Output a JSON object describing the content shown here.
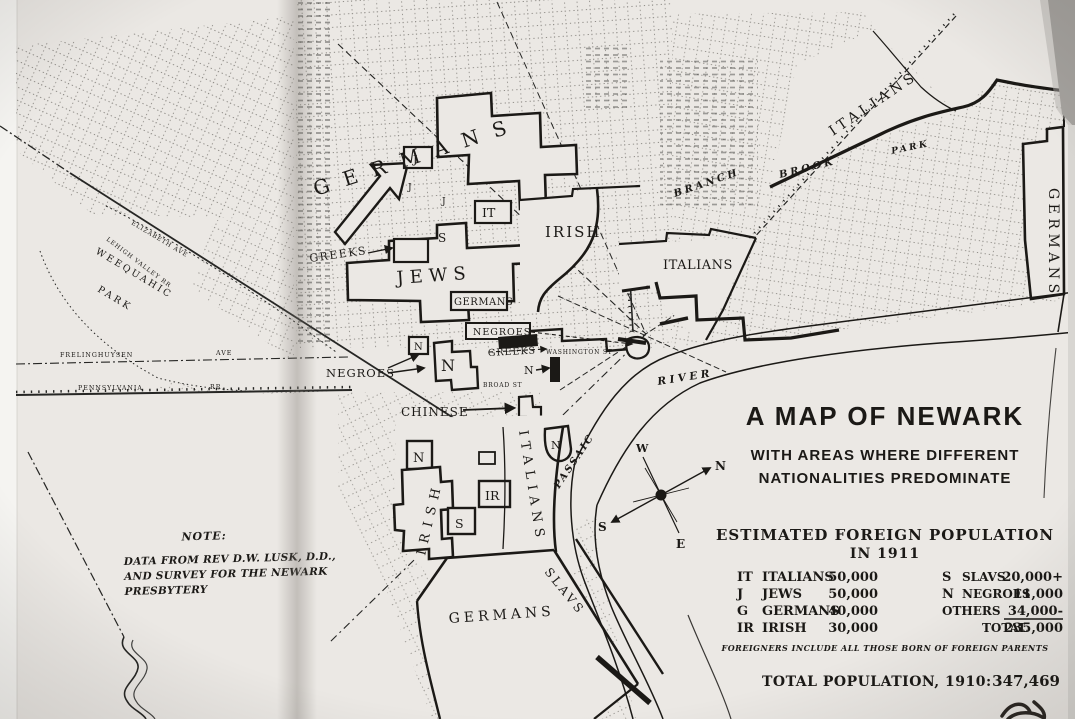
{
  "title": {
    "line1": "A MAP OF NEWARK",
    "line2": "WITH AREAS WHERE DIFFERENT",
    "line3": "NATIONALITIES PREDOMINATE"
  },
  "note": {
    "heading": "NOTE:",
    "line1": "DATA FROM REV D.W. LUSK, D.D.,",
    "line2": "AND SURVEY FOR THE NEWARK",
    "line3": "PRESBYTERY"
  },
  "legend": {
    "heading_line1": "ESTIMATED FOREIGN POPULATION",
    "heading_line2": "IN 1911",
    "left_rows": [
      {
        "abbr": "IT",
        "name": "ITALIANS",
        "value": "50,000"
      },
      {
        "abbr": "J",
        "name": "JEWS",
        "value": "50,000"
      },
      {
        "abbr": "G",
        "name": "GERMANS",
        "value": "40,000"
      },
      {
        "abbr": "IR",
        "name": "IRISH",
        "value": "30,000"
      }
    ],
    "right_rows": [
      {
        "abbr": "S",
        "name": "SLAVS",
        "value": "20,000+"
      },
      {
        "abbr": "N",
        "name": "NEGROES",
        "value": "11,000"
      },
      {
        "abbr": "",
        "name": "OTHERS",
        "value": "34,000-"
      },
      {
        "abbr": "",
        "name": "TOTAL",
        "value": "235,000"
      }
    ],
    "footnote": "FOREIGNERS INCLUDE ALL THOSE BORN OF FOREIGN PARENTS",
    "total_label": "TOTAL POPULATION, 1910:",
    "total_value": "347,469"
  },
  "compass": {
    "n": "N",
    "s": "S",
    "e": "E",
    "w": "W"
  },
  "districts": {
    "germans_central": "GERMANS",
    "jews": "JEWS",
    "germans_box": "GERMANS",
    "negroes_box": "NEGROES",
    "negroes_west": "NEGROES",
    "greeks_west": "GREEKS",
    "greeks_central": "GREEKS",
    "chinese": "CHINESE",
    "irish_central": "IRISH",
    "italians_central": "ITALIANS",
    "italians_north": "ITALIANS",
    "germans_east": "GERMANS",
    "irish_south": "IRISH",
    "italians_south": "ITALIANS",
    "slavs_south": "SLAVS",
    "germans_south": "GERMANS"
  },
  "abbrevs": {
    "j": "J",
    "it": "IT",
    "s": "S",
    "n": "N",
    "ir": "IR"
  },
  "places": {
    "weequahic": "WEEQUAHIC",
    "weequahic_park": "PARK",
    "branch": "BRANCH",
    "brook": "BROOK",
    "park_ne": "PARK",
    "passaic": "PASSAIC",
    "river": "RIVER"
  },
  "streets": {
    "frelinghuysen": "FRELINGHUYSEN",
    "ave": "AVE",
    "pennsylvania": "PENNSYLVANIA",
    "rr": "RR",
    "elizabeth_ave": "ELIZABETH AVE",
    "lehigh_valley_rr": "LEHIGH VALLEY RR",
    "washington_st": "WASHINGTON ST",
    "broad_st": "BROAD ST"
  },
  "colors": {
    "paper": "#ebe8e4",
    "ink": "#1b1916",
    "page_edge_gray": "#a5a29e"
  }
}
